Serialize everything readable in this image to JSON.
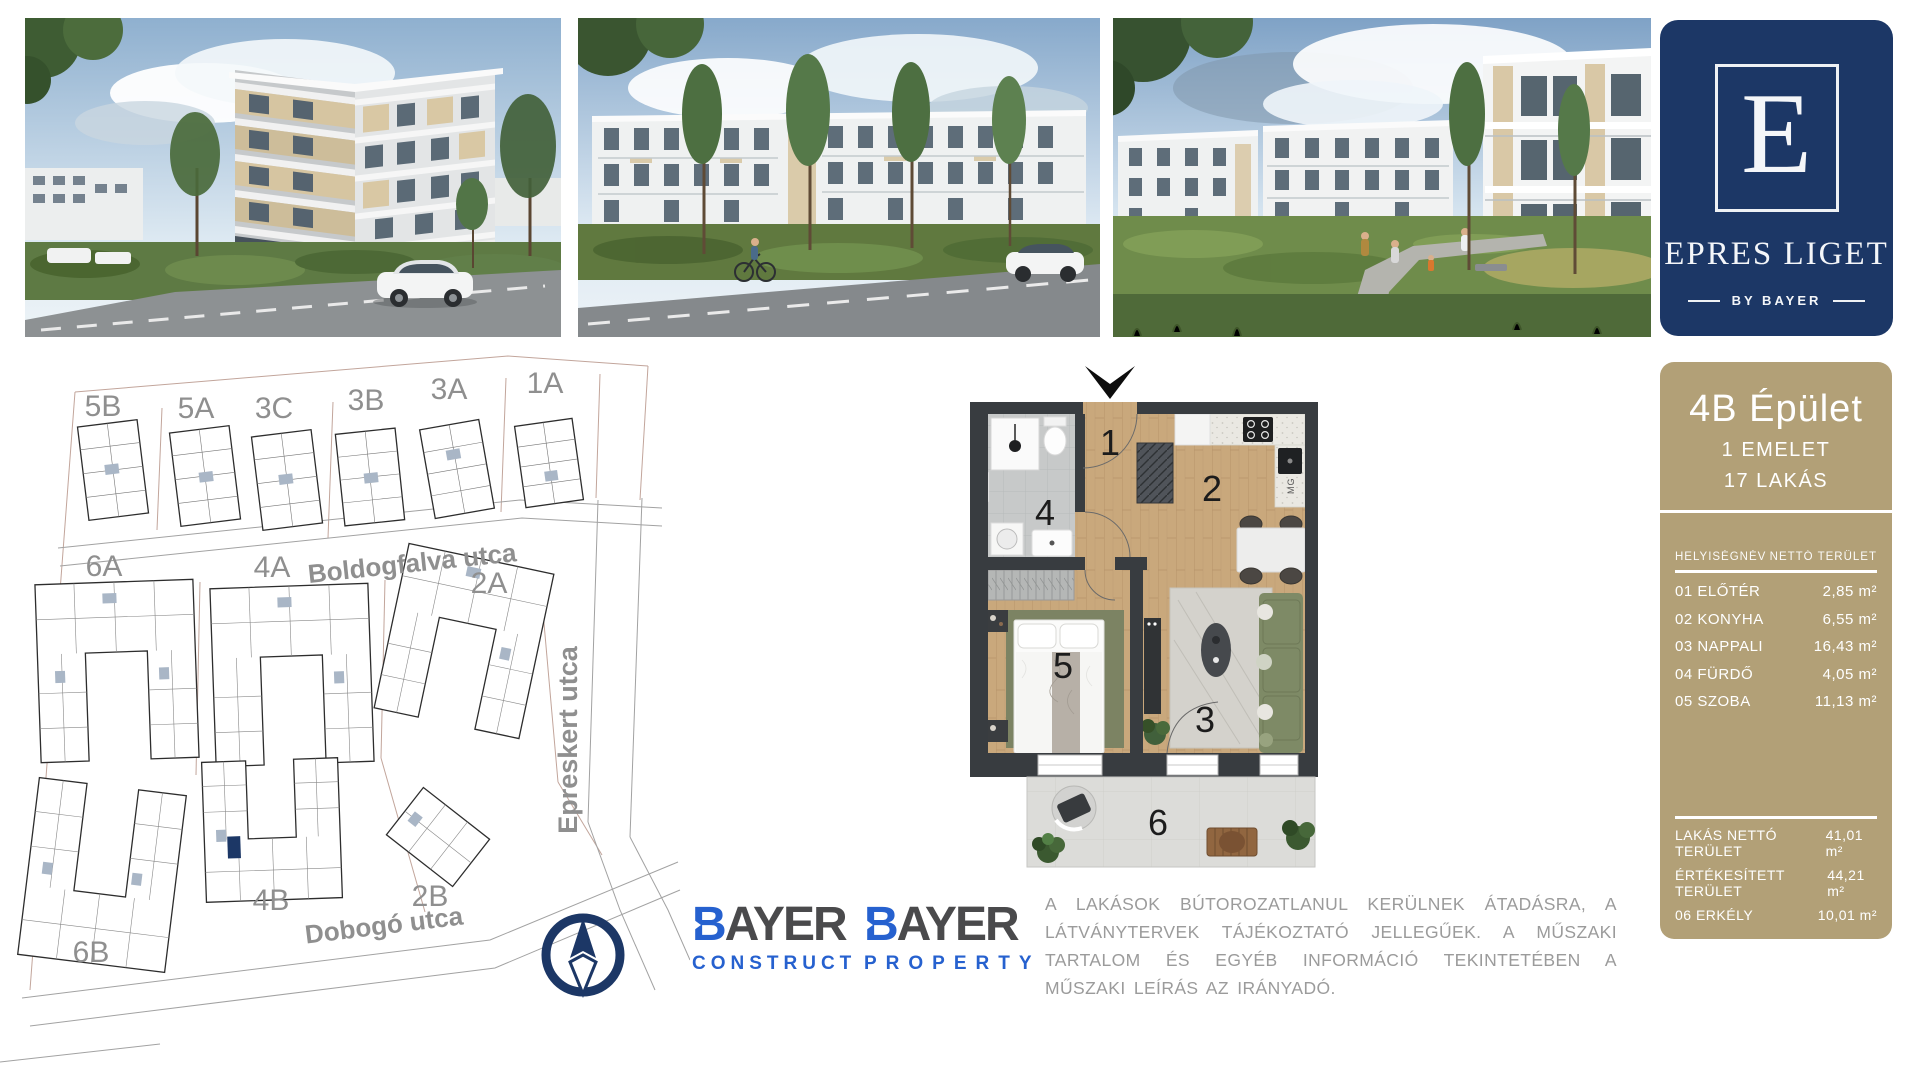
{
  "brand_panel": {
    "monogram": "E",
    "name": "EPRES LIGET",
    "byline": "BY BAYER",
    "bg_color": "#1c3766"
  },
  "site_map": {
    "buildings": [
      {
        "label": "5B"
      },
      {
        "label": "5A"
      },
      {
        "label": "3C"
      },
      {
        "label": "3B"
      },
      {
        "label": "3A"
      },
      {
        "label": "1A"
      },
      {
        "label": "6A"
      },
      {
        "label": "4A"
      },
      {
        "label": "2A"
      },
      {
        "label": "2B"
      },
      {
        "label": "4B"
      },
      {
        "label": "6B"
      }
    ],
    "streets": [
      {
        "label": "Boldogfalva utca"
      },
      {
        "label": "Epreskert utca"
      },
      {
        "label": "Dobogó utca"
      }
    ],
    "highlight_color": "#1c3766"
  },
  "floor_plan": {
    "rooms": [
      "1",
      "2",
      "3",
      "4",
      "5",
      "6"
    ],
    "appliance_label": "MG"
  },
  "info_panel": {
    "title": "4B Épület",
    "subtitle1": "1 EMELET",
    "subtitle2": "17 LAKÁS",
    "table_header": {
      "name": "HELYISÉGNÉV",
      "area": "NETTÓ TERÜLET"
    },
    "rooms": [
      {
        "name": "01 ELŐTÉR",
        "area": "2,85 m²"
      },
      {
        "name": "02 KONYHA",
        "area": "6,55 m²"
      },
      {
        "name": "03 NAPPALI",
        "area": "16,43 m²"
      },
      {
        "name": "04 FÜRDŐ",
        "area": "4,05 m²"
      },
      {
        "name": "05 SZOBA",
        "area": "11,13 m²"
      }
    ],
    "totals": [
      {
        "name": "LAKÁS NETTÓ TERÜLET",
        "area": "41,01 m²"
      },
      {
        "name": "ÉRTÉKESÍTETT TERÜLET",
        "area": "44,21 m²"
      },
      {
        "name": "06 ERKÉLY",
        "area": "10,01 m²"
      }
    ],
    "bg_color": "#b2a077"
  },
  "logos": {
    "construct": {
      "initial": "B",
      "rest": "AYER",
      "division": "CONSTRUCT"
    },
    "property": {
      "initial": "B",
      "rest": "AYER",
      "division": "PROPERTY"
    }
  },
  "disclaimer": "A LAKÁSOK BÚTOROZATLANUL KERÜLNEK ÁTADÁSRA, A LÁTVÁNYTERVEK TÁJÉKOZTATÓ JELLEGŰEK. A MŰSZAKI TARTALOM ÉS EGYÉB INFORMÁCIÓ TEKINTETÉBEN A MŰSZAKI LEÍRÁS AZ IRÁNYADÓ."
}
